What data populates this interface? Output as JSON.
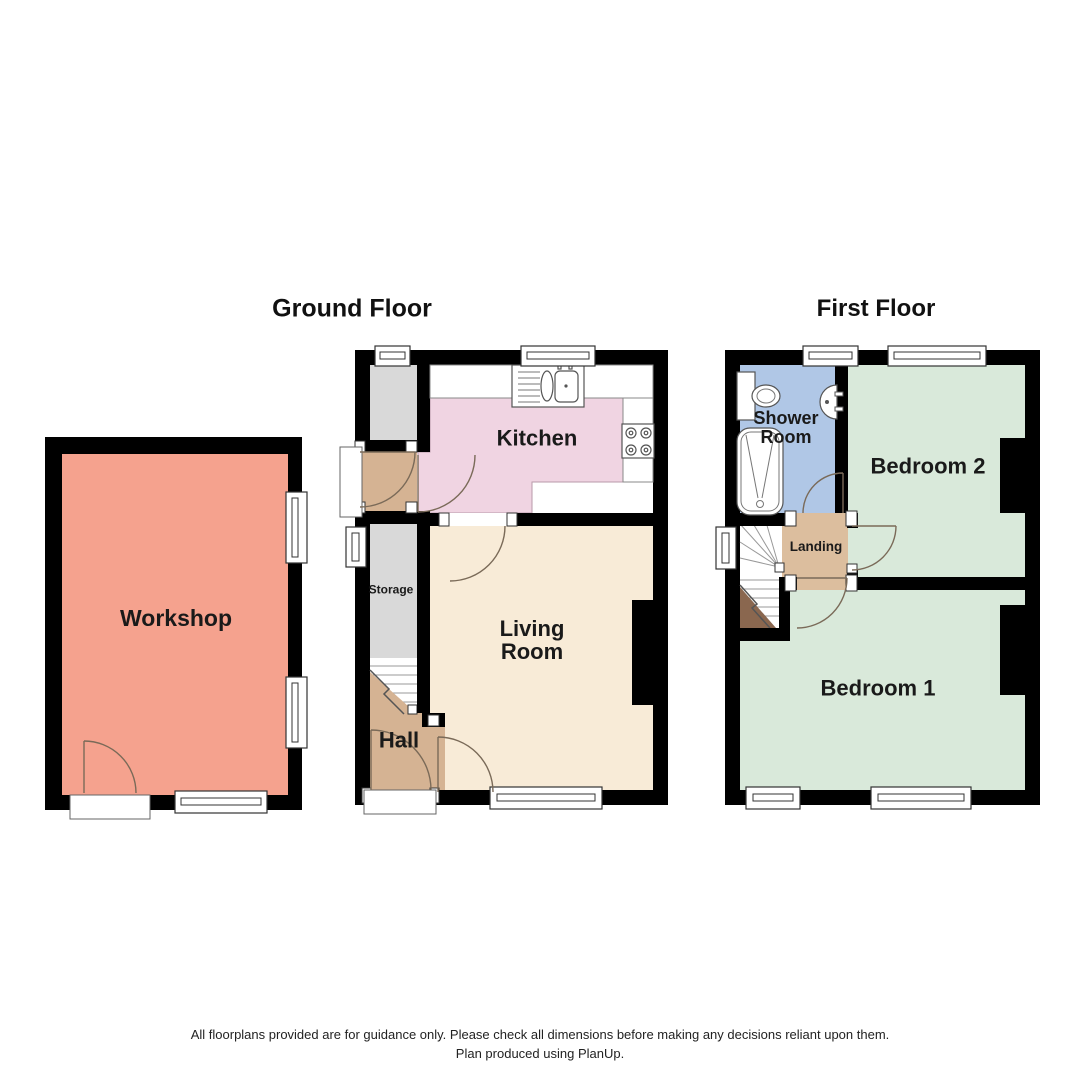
{
  "titles": {
    "ground": "Ground Floor",
    "first": "First Floor"
  },
  "rooms": {
    "workshop": {
      "name": "Workshop",
      "color": "#f5a28e"
    },
    "kitchen": {
      "name": "Kitchen",
      "color": "#f0d4e2"
    },
    "living_room": {
      "name": "Living Room",
      "color": "#f8ebd7"
    },
    "hall": {
      "name": "Hall",
      "color": "#d5b393"
    },
    "storage": {
      "name": "Storage",
      "color": "#d9d9d9"
    },
    "shower_room": {
      "name": "Shower Room",
      "color": "#b0c7e6"
    },
    "bedroom2": {
      "name": "Bedroom 2",
      "color": "#d9e9da"
    },
    "landing": {
      "name": "Landing",
      "color": "#dcbe9e"
    },
    "bedroom1": {
      "name": "Bedroom 1",
      "color": "#d9e9da"
    }
  },
  "colors": {
    "wall": "#000000",
    "door_arc": "#7a6a58",
    "stair_underside": "#8a674f",
    "fixture_line": "#555555"
  },
  "footer": {
    "disclaimer": "All floorplans provided are for guidance only. Please check all dimensions before making any decisions reliant upon them.",
    "produced": "Plan produced using PlanUp."
  }
}
